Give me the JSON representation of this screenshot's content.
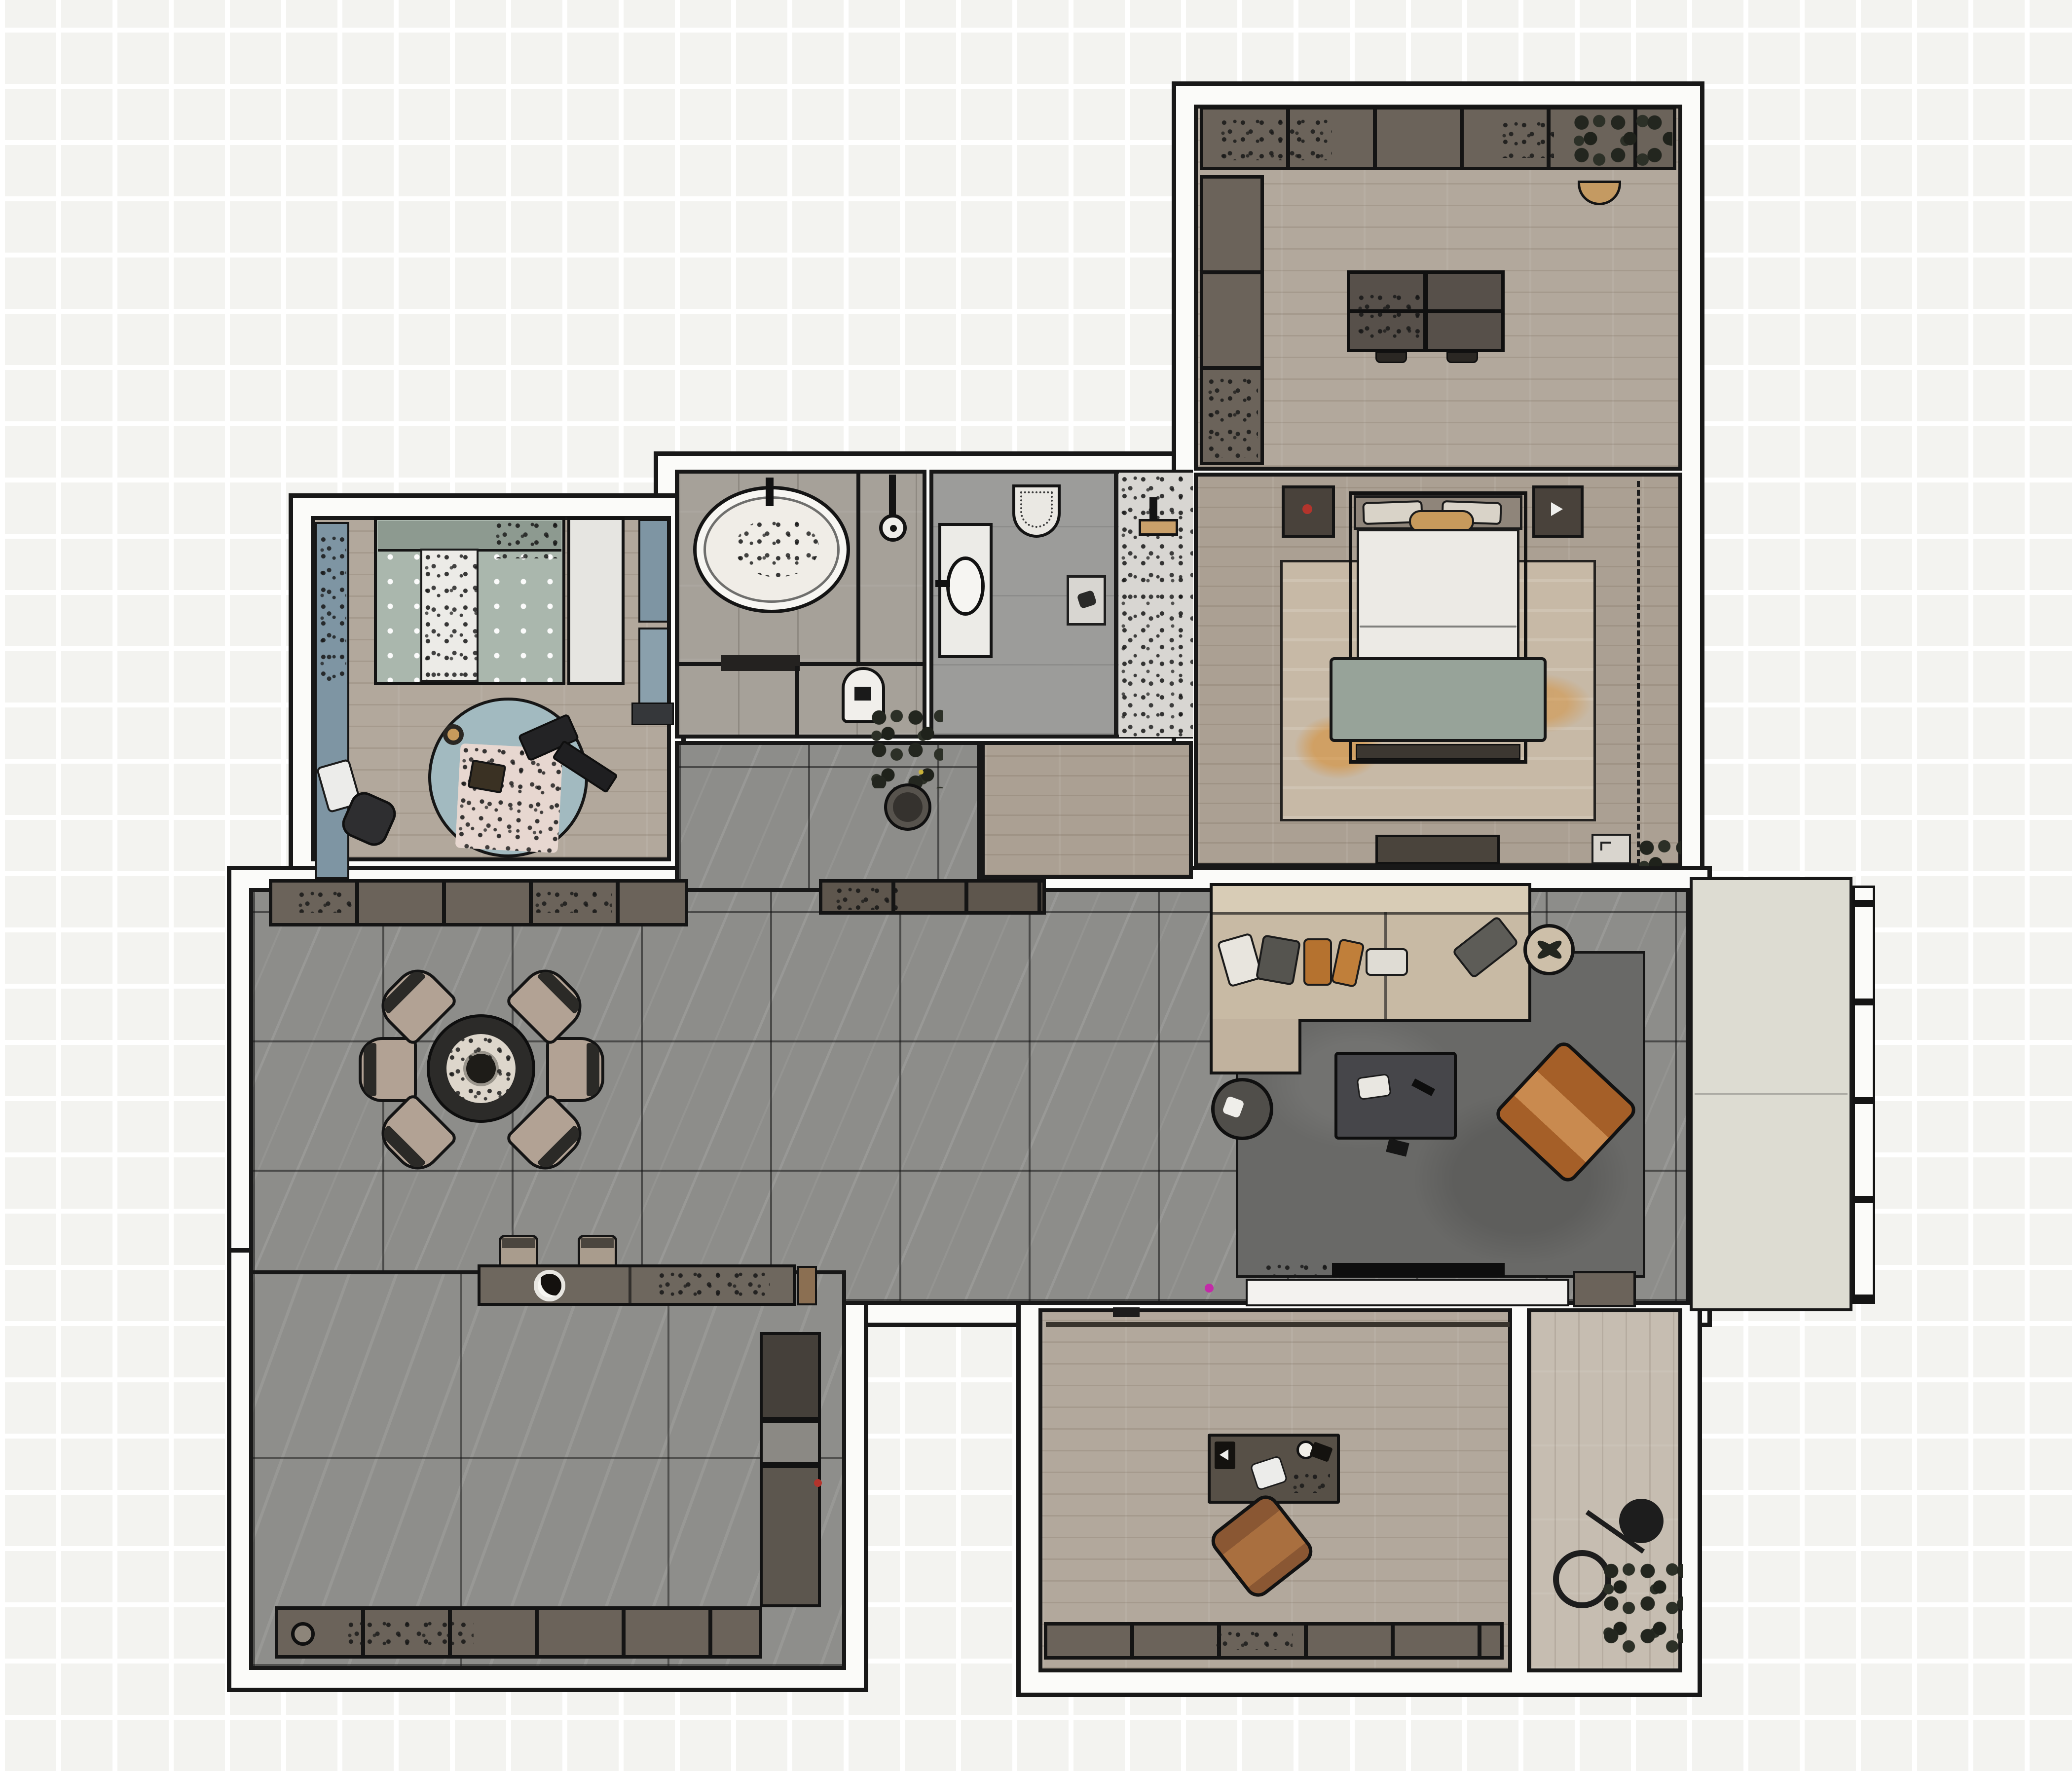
{
  "app": {
    "title": "Apartment floor plan — rendered top view",
    "view": "2D plan render",
    "visible_text": "none"
  },
  "palette": {
    "background": "#f3f3f0",
    "wall_line": "#181818",
    "wall_fill": "#fbfbf9",
    "wood_floor": "#b2a89c",
    "wood_floor_dark": "#aba093",
    "wood_floor_light": "#c6bdb1",
    "tile_dining": "#8d8d8a",
    "tile_kitchen": "#8e8e8b",
    "tile_bath": "#a6a199",
    "cabinet": "#6b635a",
    "cabinet_dark": "#49423b",
    "sofa_beige": "#c8baa4",
    "accent_orange": "#b5722f",
    "armchair_cognac": "#a55f28",
    "kids_teal": "#7e95a3",
    "sage_green": "#99a399",
    "rug_living": "#696967",
    "rug_bedroom": "#c7b9a6",
    "rug_kids": "#a2bac0",
    "balcony_floor": "#dddcd2",
    "magenta_marker": "#c22ba8",
    "red_marker": "#b3342c"
  },
  "rooms": [
    {
      "id": "study",
      "name": "Study / multipurpose room",
      "floor": "light wood plank",
      "furniture": [
        "upper cabinet row with plants",
        "tall side cabinet column",
        "center island table with utensils",
        "two island stools",
        "basket"
      ]
    },
    {
      "id": "master_bedroom",
      "name": "Master bedroom",
      "floor": "wood plank",
      "furniture": [
        "double bed with white duvet and sage throw",
        "two nightstands",
        "beige rug with orange streaks",
        "TV console",
        "dashed wardrobe zone",
        "door mat",
        "corner plant"
      ]
    },
    {
      "id": "kids_bedroom",
      "name": "Kids bedroom",
      "floor": "wood plank",
      "furniture": [
        "single bed with dotted sage bedding",
        "white wardrobe",
        "desk strip with chair",
        "round teal play rug",
        "pink blanket",
        "toys",
        "wall shelf"
      ]
    },
    {
      "id": "bathroom",
      "name": "Bathroom",
      "floor": "gray plank tile",
      "furniture": [
        "oval bathtub",
        "tub faucet",
        "shower head",
        "glass partition",
        "bath mat",
        "water boiler"
      ]
    },
    {
      "id": "wc",
      "name": "Shower room / WC",
      "floor": "gray tile",
      "furniture": [
        "vanity with oval basin",
        "toilet",
        "floor drain",
        "textured shower stall with glass screen",
        "shower fixture"
      ]
    },
    {
      "id": "corridor",
      "name": "Corridor / laundry nook",
      "floor": "gray tile + wood",
      "furniture": [
        "large potted plant"
      ]
    },
    {
      "id": "dining_area",
      "name": "Dining area",
      "floor": "dark gray marble tile",
      "furniture": [
        "round dining table with place settings",
        "six upholstered chairs",
        "sideboard cabinet row",
        "hall cabinet row",
        "two bar stools"
      ]
    },
    {
      "id": "living_room",
      "name": "Living room",
      "floor": "dark gray marble tile",
      "furniture": [
        "L-shaped beige sectional sofa",
        "throw pillows white gray orange",
        "round side table",
        "dark coffee table",
        "cognac armchair",
        "potted plant",
        "dark gray rug",
        "TV with white media bench",
        "media cabinet",
        "magenta marker dot"
      ]
    },
    {
      "id": "kitchen",
      "name": "Kitchen",
      "floor": "large gray tile",
      "furniture": [
        "bar counter with sink and cookware",
        "base cabinet row with knob",
        "tall cabinet column",
        "red marker dot"
      ]
    },
    {
      "id": "den",
      "name": "Den / home office",
      "floor": "wood plank",
      "furniture": [
        "desk with lamp phone and cup",
        "cognac leather chair",
        "low cabinet row",
        "sliding rail",
        "arc floor lamp",
        "potted plant",
        "light wood side strip"
      ]
    },
    {
      "id": "balcony",
      "name": "Balcony",
      "floor": "pale screed",
      "furniture": [
        "railing with posts"
      ]
    }
  ]
}
